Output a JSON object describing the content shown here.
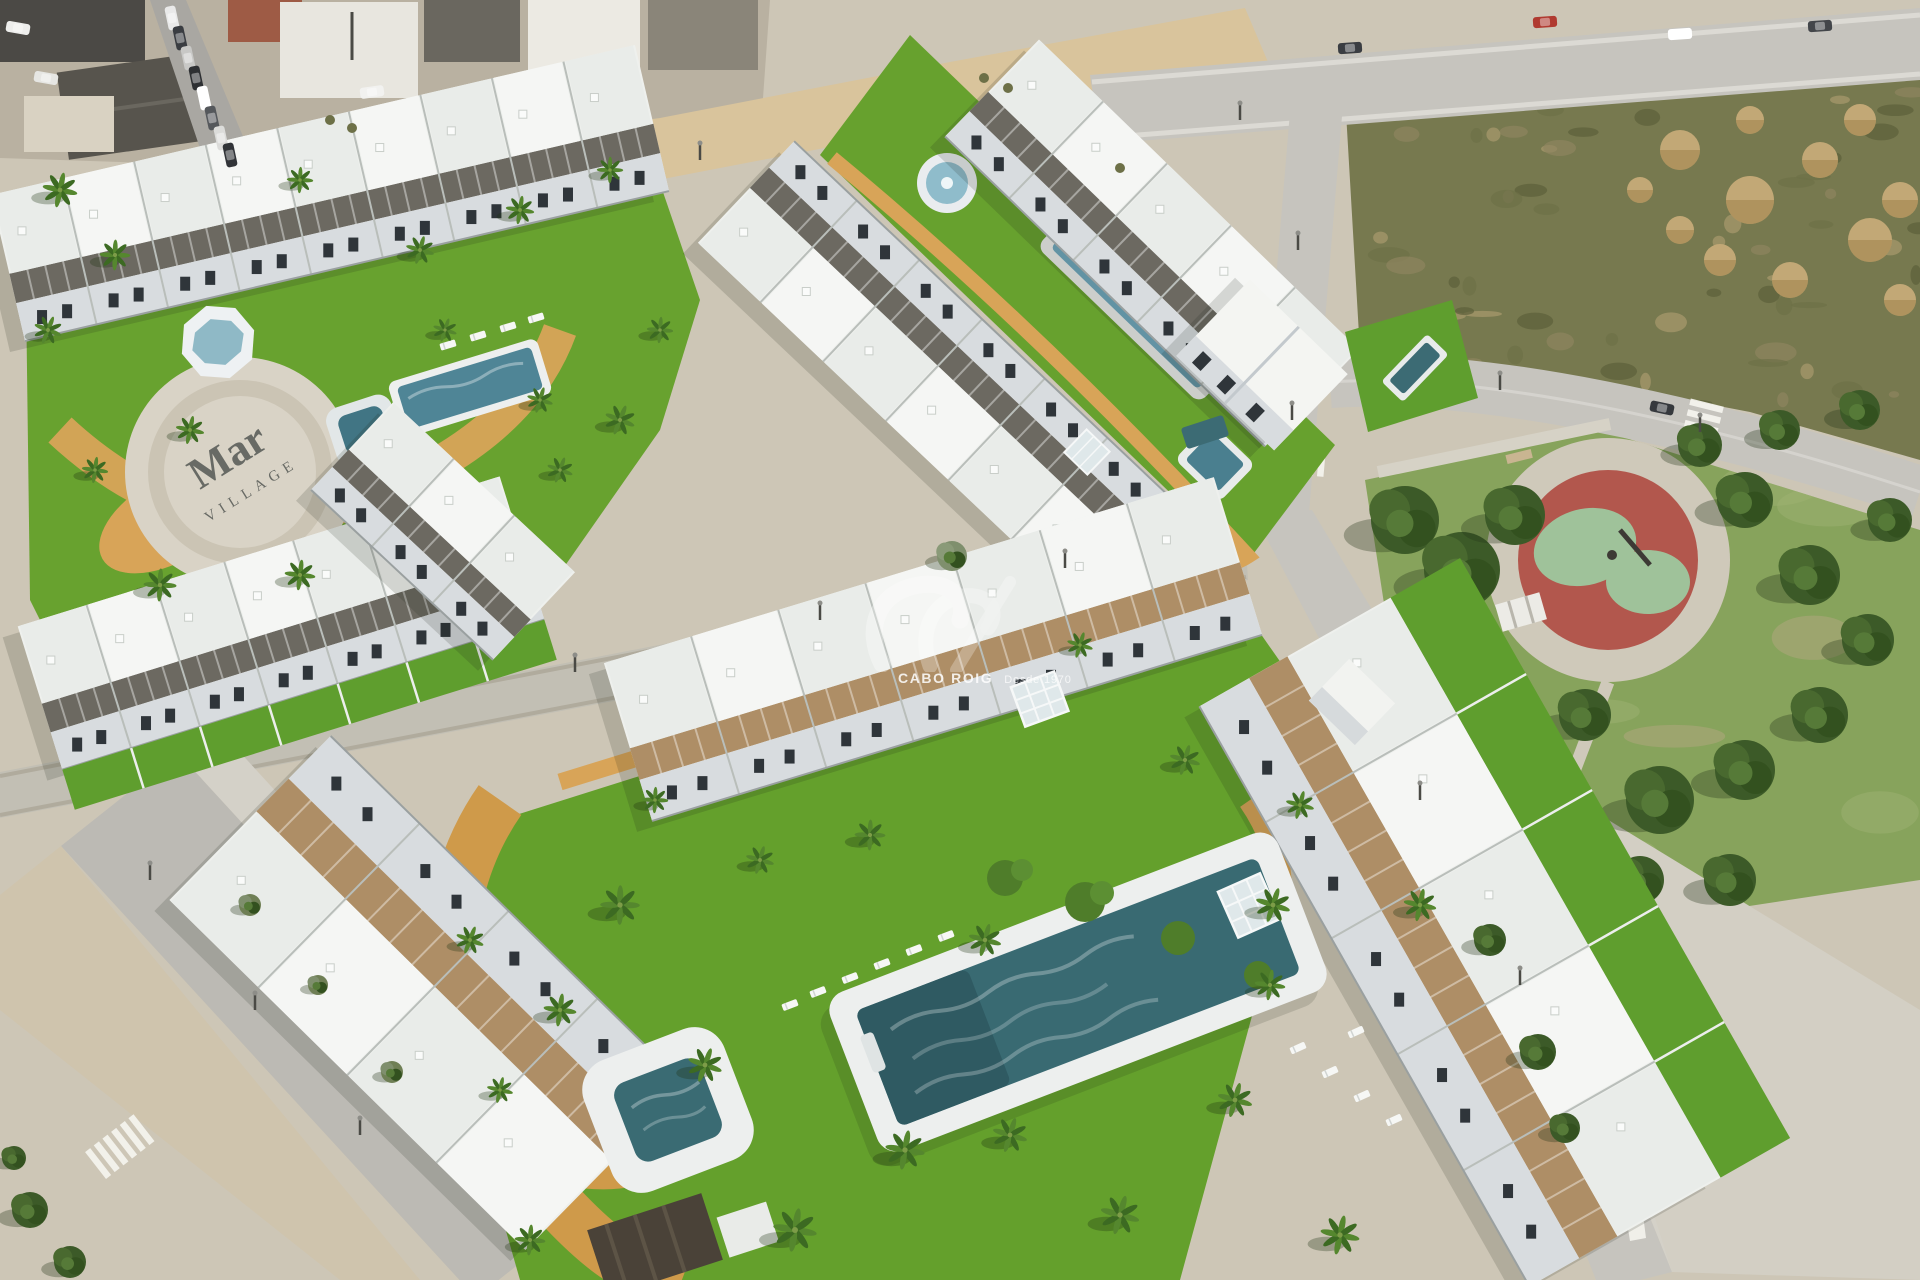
{
  "scene": {
    "type": "aerial-3d-architectural-render",
    "watermark": {
      "brand": "CABO ROIG",
      "tagline": "Desde 1970"
    },
    "plaza_text": {
      "line1": "Mar",
      "line2": "VILLAGE"
    },
    "regions": [
      "existing-town",
      "vacant-scrub-lot",
      "dirt-mounds",
      "public-park",
      "circular-playground",
      "communal-green-strip",
      "lap-pool",
      "round-fountain",
      "square-pool",
      "upper-left-gardens",
      "ground-plaza",
      "octagon-fountain",
      "plunge-pool",
      "lower-complex-lawn",
      "main-pool",
      "kids-pool",
      "townhouse-rows",
      "apartment-rows",
      "corner-villa",
      "roads",
      "palm-trees"
    ]
  },
  "palette": {
    "grass": "#64a02c",
    "grass_light": "#6fae33",
    "park_grass": "#87a35c",
    "scrub": "#77794f",
    "sand": "#d9c49c",
    "path_ochre": "#d8a458",
    "road": "#c6c4be",
    "sidewalk": "#d8d5cd",
    "building_white": "#f3f4f2",
    "facade_shade": "#d8dcdf",
    "window_dark": "#2f353a",
    "pergola_charcoal": "#615d55",
    "pergola_tan": "#a8855a",
    "pool_dark": "#396a72",
    "pool_light": "#6fa8bf",
    "playground_red": "#b2574d",
    "playground_green": "#9fc29a",
    "roof_town_dark": "#57544d",
    "roof_terracotta": "#9e5b45",
    "tree_green": "#3c5a28",
    "watermark_white": "#ffffff"
  }
}
